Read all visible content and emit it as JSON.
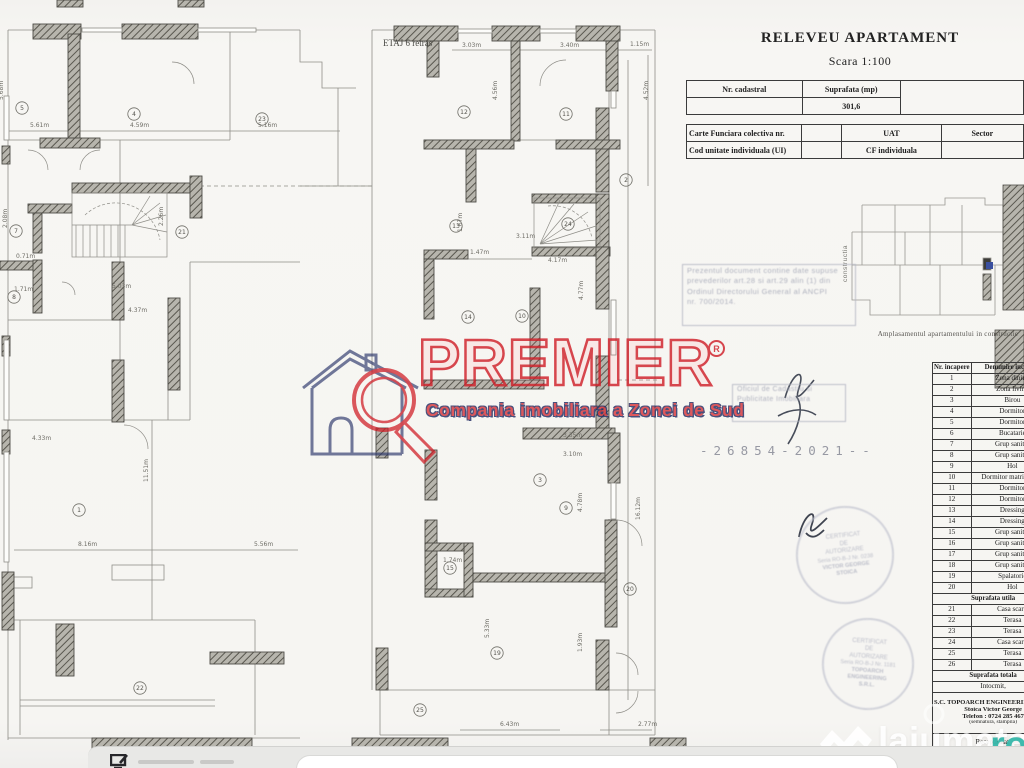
{
  "doc": {
    "title": "RELEVEU APARTAMENT",
    "scale": "Scara 1:100",
    "floor_label": "ETAJ 6 retras",
    "cad_table": {
      "nr_cadastral": "Nr. cadastral",
      "suprafata": "Suprafata (mp)",
      "suprafata_value": "301,6"
    },
    "cf_table": {
      "carte_funciara": "Carte Funciara colectiva nr.",
      "uat": "UAT",
      "sector": "Sector",
      "cod_unitate": "Cod unitate individuala (UI)",
      "cf_individuala": "CF individuala"
    },
    "location_plan": {
      "caption": "Amplasamentul apartamentului in constructie",
      "side_label": "constructia"
    },
    "rooms_table": {
      "headers": [
        "Nr. incapere",
        "Denumire incapere"
      ],
      "rows": [
        [
          "1",
          "Zona dining"
        ],
        [
          "2",
          "Zona living"
        ],
        [
          "3",
          "Birou"
        ],
        [
          "4",
          "Dormitor"
        ],
        [
          "5",
          "Dormitor"
        ],
        [
          "6",
          "Bucatarie"
        ],
        [
          "7",
          "Grup sanitar"
        ],
        [
          "8",
          "Grup sanitar"
        ],
        [
          "9",
          "Hol"
        ],
        [
          "10",
          "Dormitor matrimonial"
        ],
        [
          "11",
          "Dormitor"
        ],
        [
          "12",
          "Dormitor"
        ],
        [
          "13",
          "Dressing"
        ],
        [
          "14",
          "Dressing"
        ],
        [
          "15",
          "Grup sanitar"
        ],
        [
          "16",
          "Grup sanitar"
        ],
        [
          "17",
          "Grup sanitar"
        ],
        [
          "18",
          "Grup sanitar"
        ],
        [
          "19",
          "Spalatorie"
        ],
        [
          "20",
          "Hol"
        ]
      ],
      "subtotal_label": "Suprafata utila",
      "rows2": [
        [
          "21",
          "Casa scarii"
        ],
        [
          "22",
          "Terasa"
        ],
        [
          "23",
          "Terasa"
        ],
        [
          "24",
          "Casa scarii"
        ],
        [
          "25",
          "Terasa"
        ],
        [
          "26",
          "Terasa"
        ]
      ],
      "total_label": "Suprafata totala",
      "intocmit": "Intocmit,",
      "company": "S.C. TOPOARCH ENGINEERING S.R.L.",
      "author": "Stoica Victor George",
      "phone": "Telefon : 0724 285 467",
      "sign_note": "(semnatura, stampila)",
      "received": "Receptionat,",
      "received_note": "( nume, prenume, semnatura )"
    },
    "stamps": {
      "ancpi_lines": [
        "Prezentul document contine date supuse",
        "prevederilor art.28 si art.29 alin (1) din",
        "Ordinul Directorului General al ANCPI",
        "nr. 700/2014."
      ],
      "registry_lines": [
        "Oficiul de Cadastru si",
        "Publicitate Imobiliara"
      ],
      "doc_number": "-26854-2021--",
      "round1": [
        "CERTIFICAT",
        "DE",
        "AUTORIZARE",
        "Seria RO-B-J Nr. 0238",
        "VICTOR GEORGE",
        "STOICA"
      ],
      "round2": [
        "CERTIFICAT",
        "DE",
        "AUTORIZARE",
        "Seria RO-B-J Nr. 1181",
        "TOPOARCH",
        "ENGINEERING",
        "S.R.L."
      ]
    }
  },
  "watermarks": {
    "premier": {
      "brand": "PREMIER",
      "reg": "R",
      "tagline": "Compania imobiliara a Zonei de Sud",
      "red": "#d02029",
      "navy": "#232d63"
    },
    "lajumate": {
      "name": "lajumate",
      "tld": ".ro",
      "teal": "#36b7aa"
    }
  },
  "plan": {
    "dims": [
      {
        "t": "5.61m",
        "x": 30,
        "y": 127
      },
      {
        "t": "4.59m",
        "x": 130,
        "y": 127
      },
      {
        "t": "5.16m",
        "x": 258,
        "y": 127
      },
      {
        "t": "3.03m",
        "x": 462,
        "y": 47
      },
      {
        "t": "3.40m",
        "x": 560,
        "y": 47
      },
      {
        "t": "1.15m",
        "x": 630,
        "y": 46
      },
      {
        "t": "5.68m",
        "x": 3,
        "y": 100,
        "r": -90
      },
      {
        "t": "4.56m",
        "x": 497,
        "y": 100,
        "r": -90
      },
      {
        "t": "4.52m",
        "x": 648,
        "y": 100,
        "r": -90
      },
      {
        "t": "2.08m",
        "x": 7,
        "y": 228,
        "r": -90
      },
      {
        "t": "0.71m",
        "x": 16,
        "y": 258
      },
      {
        "t": "1.71m",
        "x": 14,
        "y": 291
      },
      {
        "t": "5.03m",
        "x": 112,
        "y": 288
      },
      {
        "t": "4.37m",
        "x": 128,
        "y": 312
      },
      {
        "t": "4.33m",
        "x": 32,
        "y": 440
      },
      {
        "t": "8.16m",
        "x": 78,
        "y": 546
      },
      {
        "t": "5.56m",
        "x": 254,
        "y": 546
      },
      {
        "t": "11.51m",
        "x": 148,
        "y": 482,
        "r": -90
      },
      {
        "t": "2.26m",
        "x": 163,
        "y": 226,
        "r": -90
      },
      {
        "t": "1.47m",
        "x": 470,
        "y": 254
      },
      {
        "t": "3.11m",
        "x": 516,
        "y": 238
      },
      {
        "t": "4.17m",
        "x": 548,
        "y": 262
      },
      {
        "t": "1.67m",
        "x": 462,
        "y": 232,
        "r": -90
      },
      {
        "t": "3.35m",
        "x": 563,
        "y": 437
      },
      {
        "t": "3.10m",
        "x": 563,
        "y": 456
      },
      {
        "t": "4.78m",
        "x": 582,
        "y": 512,
        "r": -90
      },
      {
        "t": "4.77m",
        "x": 583,
        "y": 300,
        "r": -90
      },
      {
        "t": "1.74m",
        "x": 443,
        "y": 562
      },
      {
        "t": "5.33m",
        "x": 489,
        "y": 638,
        "r": -90
      },
      {
        "t": "1.93m",
        "x": 582,
        "y": 652,
        "r": -90
      },
      {
        "t": "6.43m",
        "x": 500,
        "y": 726
      },
      {
        "t": "2.77m",
        "x": 638,
        "y": 726
      },
      {
        "t": "16.12m",
        "x": 640,
        "y": 520,
        "r": -90
      }
    ],
    "rooms": [
      {
        "n": "5",
        "x": 22,
        "y": 108
      },
      {
        "n": "4",
        "x": 134,
        "y": 114
      },
      {
        "n": "23",
        "x": 262,
        "y": 119
      },
      {
        "n": "12",
        "x": 464,
        "y": 112
      },
      {
        "n": "11",
        "x": 566,
        "y": 114
      },
      {
        "n": "7",
        "x": 16,
        "y": 231
      },
      {
        "n": "8",
        "x": 14,
        "y": 297
      },
      {
        "n": "21",
        "x": 182,
        "y": 232
      },
      {
        "n": "13",
        "x": 456,
        "y": 226
      },
      {
        "n": "24",
        "x": 568,
        "y": 224
      },
      {
        "n": "14",
        "x": 468,
        "y": 317
      },
      {
        "n": "10",
        "x": 522,
        "y": 316
      },
      {
        "n": "2",
        "x": 626,
        "y": 180
      },
      {
        "n": "1",
        "x": 79,
        "y": 510
      },
      {
        "n": "15",
        "x": 450,
        "y": 568
      },
      {
        "n": "9",
        "x": 566,
        "y": 508
      },
      {
        "n": "19",
        "x": 497,
        "y": 653
      },
      {
        "n": "20",
        "x": 630,
        "y": 589
      },
      {
        "n": "22",
        "x": 140,
        "y": 688
      },
      {
        "n": "25",
        "x": 420,
        "y": 710
      },
      {
        "n": "3",
        "x": 540,
        "y": 480
      }
    ]
  },
  "bottom_bar": {
    "icon": "monitor-icon"
  }
}
